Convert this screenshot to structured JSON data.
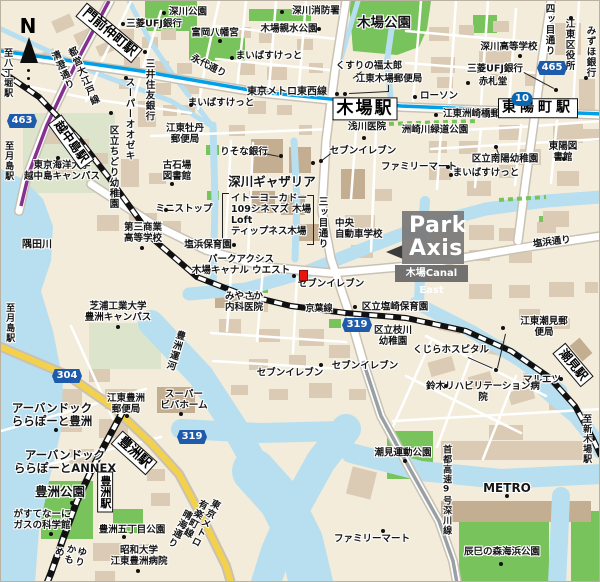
{
  "callout": {
    "logo_line1": "Park",
    "logo_line2": "Axis",
    "property_name": "木場Canal East"
  },
  "compass": {
    "north_label": "N"
  },
  "map": {
    "marker": {
      "x": 298,
      "y": 269,
      "color": "#e8150d"
    },
    "route_badges": [
      {
        "label": "463",
        "x": 21,
        "y": 120
      },
      {
        "label": "465",
        "x": 551,
        "y": 67
      },
      {
        "label": "304",
        "x": 66,
        "y": 375
      },
      {
        "label": "319",
        "x": 356,
        "y": 324
      },
      {
        "label": "319",
        "x": 191,
        "y": 436
      }
    ],
    "metro_badges": [
      {
        "label": "10",
        "x": 521,
        "y": 98
      }
    ],
    "stations": [
      {
        "t": "門前仲町駅",
        "x": 108,
        "y": 32,
        "rot": 40,
        "fs": 13
      },
      {
        "t": "越中島駅",
        "x": 70,
        "y": 141,
        "rot": 54,
        "fs": 12
      },
      {
        "t": "木場駅",
        "x": 364,
        "y": 108,
        "fs": 17,
        "ls": 2
      },
      {
        "t": "東陽町駅",
        "x": 537,
        "y": 107,
        "fs": 14,
        "ls": 4
      },
      {
        "t": "豊洲駅",
        "x": 133,
        "y": 452,
        "rot": 42,
        "fs": 13
      },
      {
        "t": "豊洲駅",
        "x": 104,
        "y": 491,
        "v": 1,
        "fs": 11
      },
      {
        "t": "潮見駅",
        "x": 572,
        "y": 364,
        "rot": 50,
        "fs": 12
      }
    ],
    "labels": [
      {
        "t": "深川公園",
        "x": 187,
        "y": 12
      },
      {
        "t": "三菱UFJ銀行",
        "x": 153,
        "y": 24
      },
      {
        "t": "富岡八幡宮",
        "x": 214,
        "y": 33
      },
      {
        "t": "深川消防署",
        "x": 315,
        "y": 11
      },
      {
        "t": "木場親水公園",
        "x": 288,
        "y": 29
      },
      {
        "t": "木場公園",
        "x": 383,
        "y": 23,
        "fs": 13.5
      },
      {
        "t": "深川高等学校",
        "x": 508,
        "y": 47
      },
      {
        "t": "三菱UFJ銀行",
        "x": 494,
        "y": 69
      },
      {
        "t": "赤札堂",
        "x": 492,
        "y": 82
      },
      {
        "t": "くすりの福太郎",
        "x": 368,
        "y": 66
      },
      {
        "t": "江東木場郵便局",
        "x": 388,
        "y": 79
      },
      {
        "t": "まいばすけっと",
        "x": 268,
        "y": 56
      },
      {
        "t": "まいばすけっと",
        "x": 220,
        "y": 103
      },
      {
        "t": "ローソン",
        "x": 438,
        "y": 96
      },
      {
        "t": "東京メトロ東西線",
        "x": 286,
        "y": 91,
        "fs": 10
      },
      {
        "t": "江東洲崎橋郵便局",
        "x": 480,
        "y": 114
      },
      {
        "t": "洲崎川緑道公園",
        "x": 434,
        "y": 130
      },
      {
        "t": "浅川医院",
        "x": 366,
        "y": 127
      },
      {
        "t": "りそな銀行",
        "x": 243,
        "y": 152
      },
      {
        "t": "セブンイレブン",
        "x": 362,
        "y": 151
      },
      {
        "t": "ファミリーマート",
        "x": 418,
        "y": 167
      },
      {
        "t": "区立南陽幼稚園",
        "x": 504,
        "y": 159
      },
      {
        "t": "まいばすけっと",
        "x": 485,
        "y": 173
      },
      {
        "t": "東陽図書館",
        "x": 562,
        "y": 152
      },
      {
        "t": "江東牡丹\n郵便局",
        "x": 184,
        "y": 134
      },
      {
        "t": "古石場\n図書館",
        "x": 176,
        "y": 171
      },
      {
        "t": "ミニストップ",
        "x": 183,
        "y": 209
      },
      {
        "t": "深川ギャザリア",
        "x": 271,
        "y": 181,
        "fs": 12.5
      },
      {
        "t": "イトーヨーカドー\n109シネマズ 木場\nLoft\nティップネス木場",
        "x": 230,
        "y": 215,
        "a": "l"
      },
      {
        "t": "中央\n自動車学校",
        "x": 334,
        "y": 229,
        "a": "l"
      },
      {
        "t": "東京海洋大学\n越中島キャンパス",
        "x": 61,
        "y": 171
      },
      {
        "t": "第三商業\n高等学校",
        "x": 142,
        "y": 233
      },
      {
        "t": "隅田川",
        "x": 36,
        "y": 244,
        "fs": 10
      },
      {
        "t": "塩浜保育園",
        "x": 207,
        "y": 245
      },
      {
        "t": "パークアクシス\n木場キャナル ウエスト",
        "x": 240,
        "y": 265
      },
      {
        "t": "みやさか\n内科医院",
        "x": 243,
        "y": 302
      },
      {
        "t": "セブンイレブン",
        "x": 330,
        "y": 284
      },
      {
        "t": "京葉線",
        "x": 318,
        "y": 308,
        "fs": 9
      },
      {
        "t": "区立塩崎保育園",
        "x": 394,
        "y": 307
      },
      {
        "t": "区立枝川\n幼稚園",
        "x": 392,
        "y": 336
      },
      {
        "t": "くじらホスピタル",
        "x": 450,
        "y": 350
      },
      {
        "t": "江東潮見郵便局",
        "x": 543,
        "y": 327
      },
      {
        "t": "マルエツ",
        "x": 541,
        "y": 380
      },
      {
        "t": "鈴木リハビリテーション病院",
        "x": 482,
        "y": 392
      },
      {
        "t": "セブンイレブン",
        "x": 289,
        "y": 373
      },
      {
        "t": "セブンイレブン",
        "x": 364,
        "y": 366
      },
      {
        "t": "芝浦工業大学\n豊洲キャンパス",
        "x": 117,
        "y": 312
      },
      {
        "t": "江東豊洲\n郵便局",
        "x": 125,
        "y": 404
      },
      {
        "t": "スーパー\nビバホーム",
        "x": 183,
        "y": 400
      },
      {
        "t": "アーバンドック\nららぽーと豊洲",
        "x": 51,
        "y": 414,
        "fs": 11.5
      },
      {
        "t": "アーバンドック\nららぽーとANNEX",
        "x": 64,
        "y": 461,
        "fs": 11.5
      },
      {
        "t": "豊洲公園",
        "x": 59,
        "y": 491,
        "fs": 12.5
      },
      {
        "t": "がすてなーに\nガスの科学館",
        "x": 41,
        "y": 520
      },
      {
        "t": "豊洲五丁目公園",
        "x": 131,
        "y": 530
      },
      {
        "t": "昭和大学\n江東豊洲病院",
        "x": 138,
        "y": 556
      },
      {
        "t": "潮見運動公園",
        "x": 402,
        "y": 453
      },
      {
        "t": "METRO",
        "x": 506,
        "y": 488,
        "fs": 12
      },
      {
        "t": "辰巳の森海浜公園",
        "x": 501,
        "y": 552
      },
      {
        "t": "ファミリーマート",
        "x": 371,
        "y": 539
      },
      {
        "t": "至八丁堀駅",
        "x": 6,
        "y": 72,
        "v": 1,
        "fs": 9
      },
      {
        "t": "至月島駅",
        "x": 7,
        "y": 160,
        "v": 1,
        "fs": 9
      },
      {
        "t": "至月島駅",
        "x": 8,
        "y": 322,
        "v": 1,
        "fs": 9
      },
      {
        "t": "清澄通り",
        "x": 60,
        "y": 70,
        "v": 1,
        "rot": -24
      },
      {
        "t": "都営大江戸線",
        "x": 81,
        "y": 76,
        "v": 1,
        "rot": -24
      },
      {
        "t": "永代通り",
        "x": 207,
        "y": 66,
        "rot": 27
      },
      {
        "t": "三井住友銀行",
        "x": 147,
        "y": 89,
        "v": 1
      },
      {
        "t": "スーパーオオゼキ",
        "x": 127,
        "y": 118,
        "v": 1
      },
      {
        "t": "区立ちどり幼稚園",
        "x": 111,
        "y": 166,
        "v": 1
      },
      {
        "t": "四ッ目通り",
        "x": 547,
        "y": 29,
        "v": 1
      },
      {
        "t": "江東区役所",
        "x": 567,
        "y": 44,
        "v": 1
      },
      {
        "t": "みずほ銀行",
        "x": 588,
        "y": 51,
        "v": 1
      },
      {
        "t": "三ッ目通り",
        "x": 320,
        "y": 222,
        "v": 1
      },
      {
        "t": "塩浜通り",
        "x": 551,
        "y": 242,
        "rot": -7
      },
      {
        "t": "豊洲運河",
        "x": 173,
        "y": 349,
        "v": 1,
        "rot": 17
      },
      {
        "t": "首都高速9号深川線",
        "x": 445,
        "y": 489,
        "v": 1,
        "fs": 9
      },
      {
        "t": "至新木場駅",
        "x": 585,
        "y": 438,
        "v": 1,
        "fs": 9
      },
      {
        "t": "ゆりかもめ",
        "x": 67,
        "y": 553,
        "v": 1,
        "rot": 13
      },
      {
        "t": "東京メトロ有楽町線",
        "x": 198,
        "y": 519,
        "v": 1,
        "rot": 27
      },
      {
        "t": "晴海通り",
        "x": 177,
        "y": 527,
        "v": 1,
        "rot": 27
      }
    ],
    "dots": [
      [
        122,
        23
      ],
      [
        163,
        12
      ],
      [
        219,
        40
      ],
      [
        281,
        11
      ],
      [
        318,
        28
      ],
      [
        231,
        57
      ],
      [
        190,
        104
      ],
      [
        144,
        51
      ],
      [
        125,
        77
      ],
      [
        110,
        112
      ],
      [
        414,
        96
      ],
      [
        435,
        114
      ],
      [
        555,
        89
      ],
      [
        519,
        55
      ],
      [
        570,
        17
      ],
      [
        585,
        77
      ],
      [
        467,
        82
      ],
      [
        563,
        158
      ],
      [
        495,
        146
      ],
      [
        447,
        166
      ],
      [
        450,
        174
      ],
      [
        336,
        93
      ],
      [
        344,
        93
      ],
      [
        363,
        137
      ],
      [
        280,
        155
      ],
      [
        312,
        162
      ],
      [
        320,
        160
      ],
      [
        165,
        209
      ],
      [
        171,
        183
      ],
      [
        57,
        157
      ],
      [
        141,
        247
      ],
      [
        233,
        244
      ],
      [
        293,
        275
      ],
      [
        354,
        306
      ],
      [
        495,
        369
      ],
      [
        502,
        327
      ],
      [
        560,
        378
      ],
      [
        445,
        385
      ],
      [
        320,
        364
      ],
      [
        123,
        536
      ],
      [
        137,
        570
      ],
      [
        71,
        502
      ],
      [
        50,
        533
      ],
      [
        117,
        326
      ],
      [
        55,
        429
      ],
      [
        126,
        415
      ],
      [
        180,
        413
      ],
      [
        506,
        495
      ],
      [
        500,
        563
      ],
      [
        404,
        460
      ],
      [
        382,
        530
      ]
    ],
    "leader_lines": [
      [
        263,
        152,
        278,
        155
      ],
      [
        330,
        153,
        321,
        160
      ],
      [
        523,
        71,
        553,
        87
      ],
      [
        388,
        84,
        388,
        91
      ],
      [
        388,
        91,
        348,
        93
      ],
      [
        361,
        71,
        352,
        78
      ],
      [
        497,
        153,
        495,
        148
      ],
      [
        467,
        356,
        492,
        367
      ],
      [
        505,
        333,
        497,
        367
      ]
    ]
  },
  "colors": {
    "water": "#b7dff0",
    "park": "#79c35c",
    "road_casing": "#c9c2b4",
    "rail_tozai": "#00a0e9",
    "rail_oedo": "#86318f",
    "route_badge": "#1e5cab",
    "highlight_red": "#e8150d",
    "logo_gray": "#7a7a7a"
  }
}
